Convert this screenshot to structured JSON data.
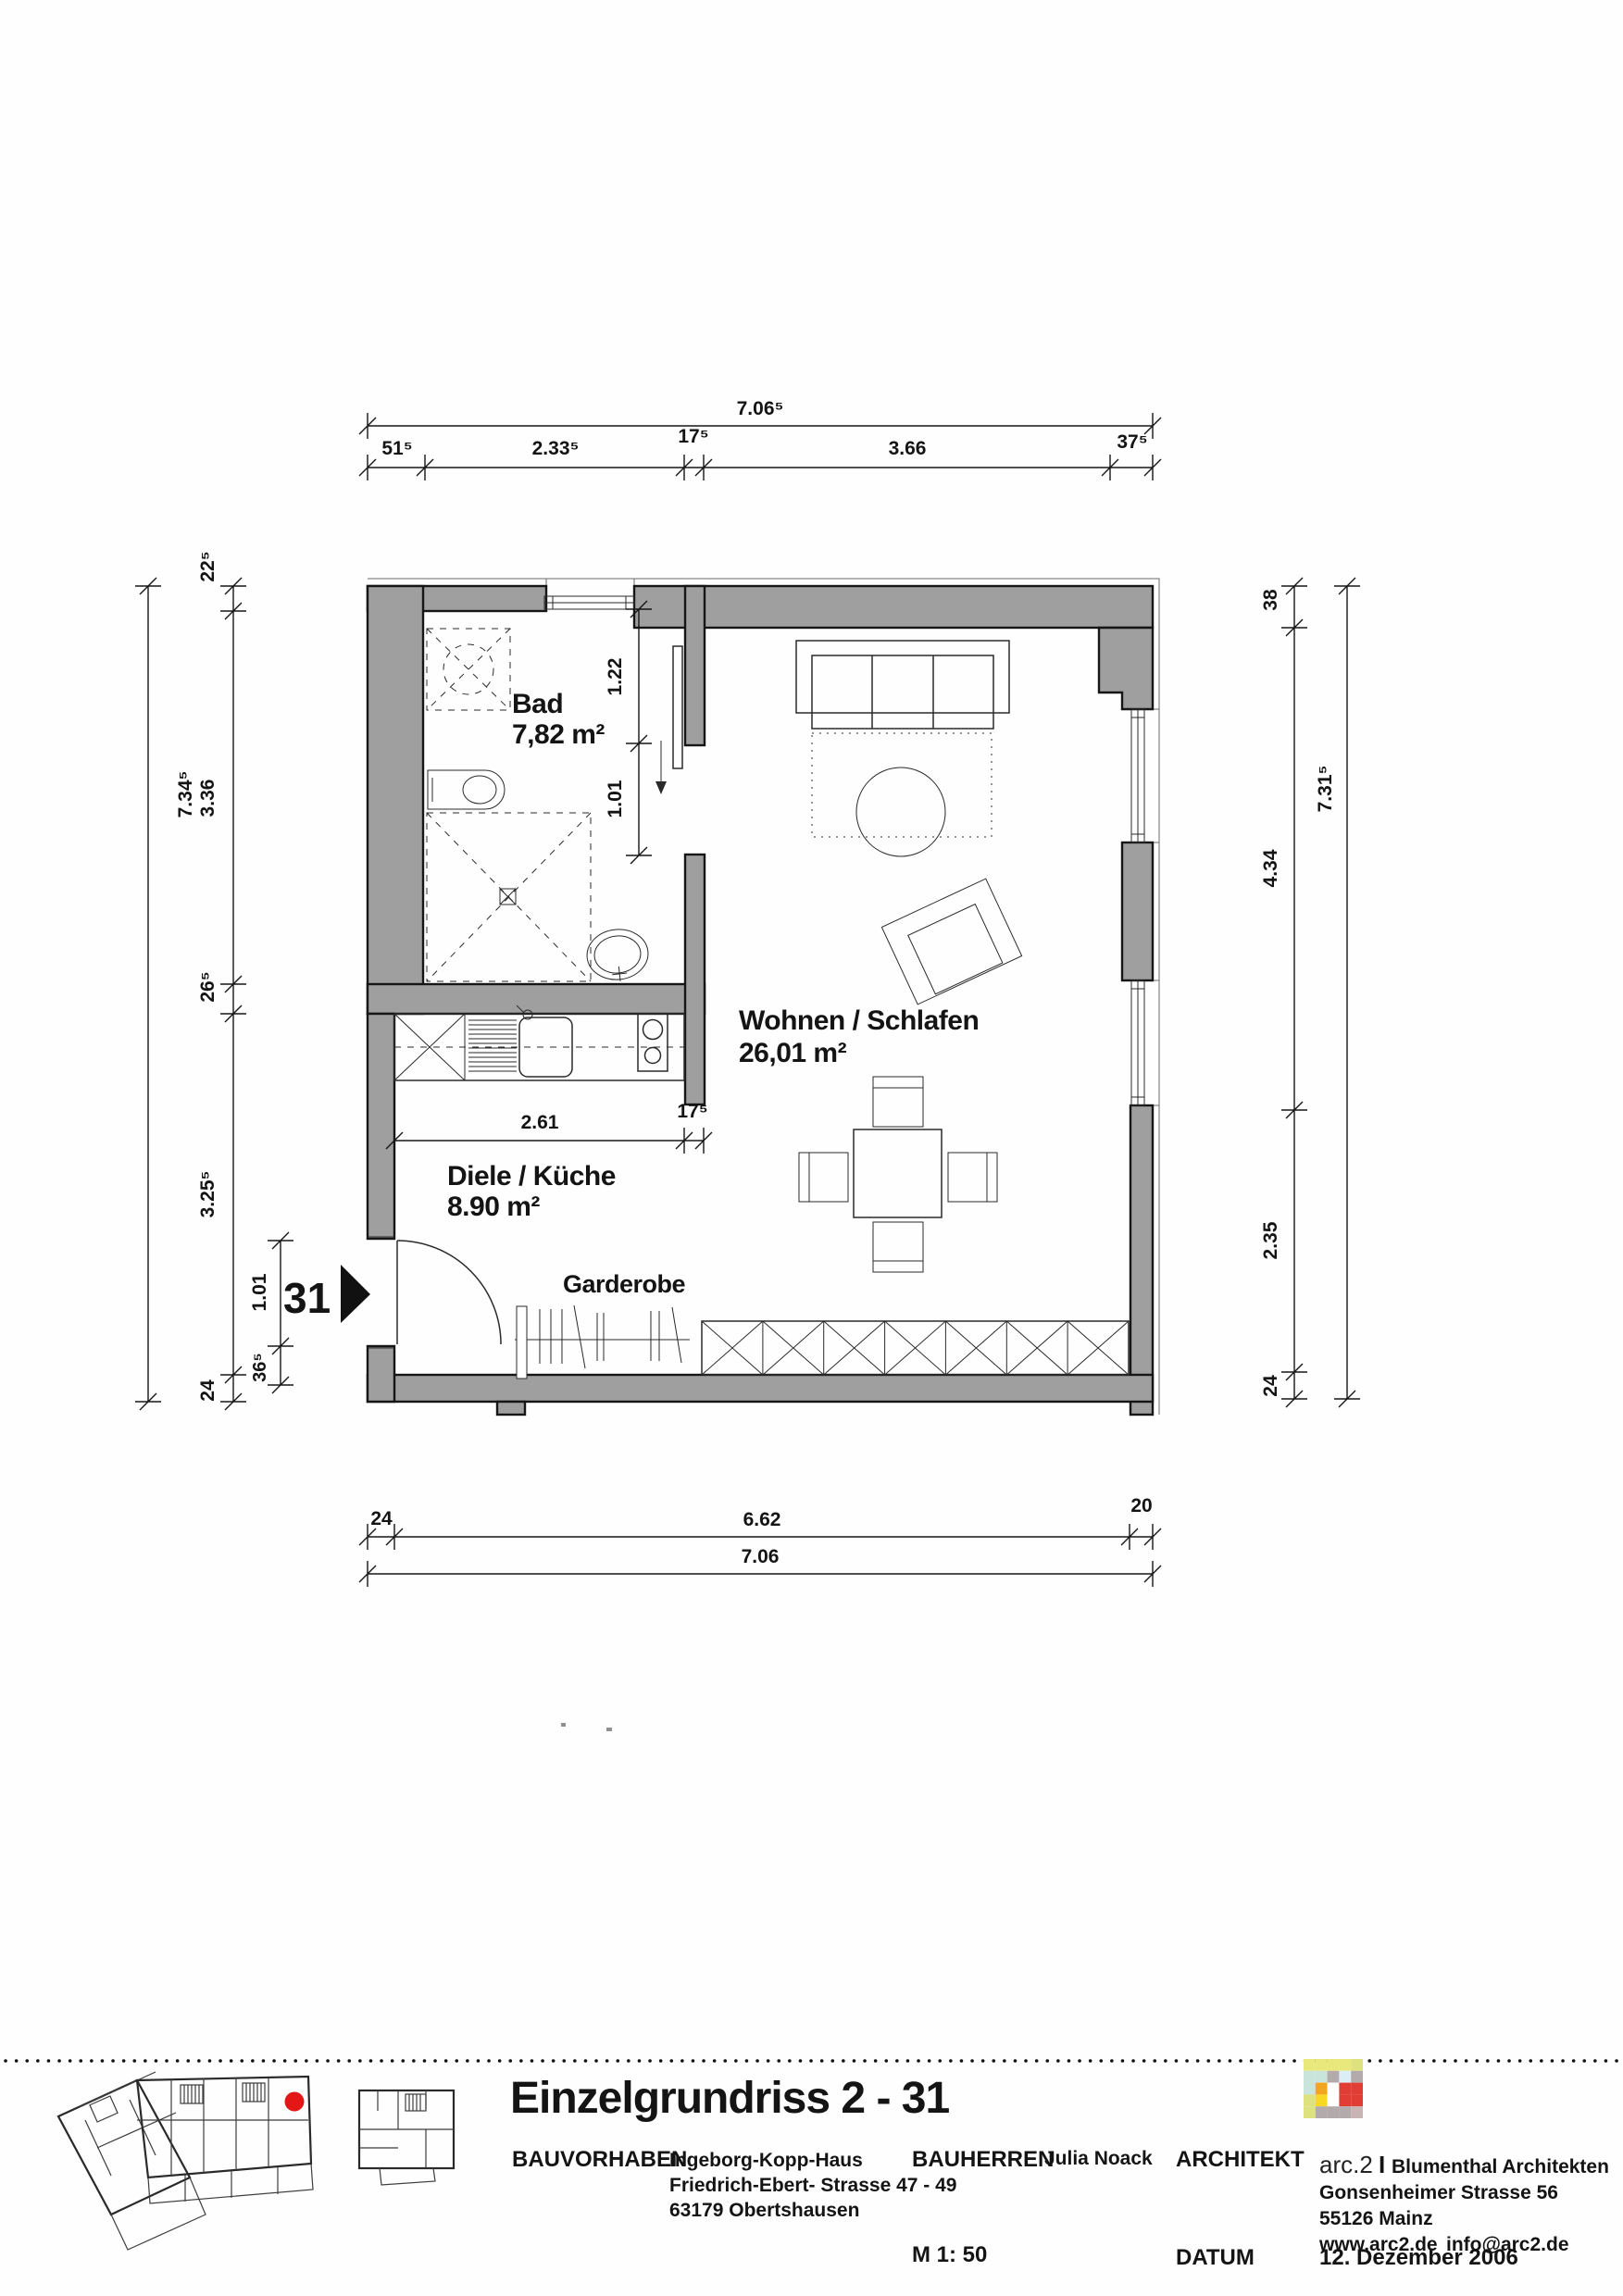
{
  "colors": {
    "wall": "#9f9f9f",
    "line": "#161616",
    "marker_red": "#e41616",
    "logo": {
      "a": "#e8e87c",
      "b": "#dde27e",
      "c": "#c9e4da",
      "d": "#dceef5",
      "e": "#f2a51f",
      "f": "#f8d823",
      "g": "#b3abab",
      "h": "#c9b4b4",
      "r": "#e23d35",
      "w": "#ffffff"
    }
  },
  "rooms": {
    "bad": {
      "name": "Bad",
      "area": "7,82 m²"
    },
    "wohnen": {
      "name": "Wohnen / Schlafen",
      "area": "26,01 m²"
    },
    "diele": {
      "name": "Diele / Küche",
      "area": "8.90 m²"
    },
    "garderobe": "Garderobe"
  },
  "entrance": {
    "unit_number": "31"
  },
  "dims": {
    "top_total": "7.06⁵",
    "top_segments": [
      "51⁵",
      "2.33⁵",
      "17⁵",
      "3.66",
      "37⁵"
    ],
    "left_total": "7.34⁵",
    "left_segments": [
      "22⁵",
      "3.36",
      "26⁵",
      "3.25⁵",
      "24"
    ],
    "right_total": "7.31⁵",
    "right_segments": [
      "38",
      "4.34",
      "2.35",
      "24"
    ],
    "bottom_total": "7.06",
    "bottom_segments": [
      "24",
      "6.62",
      "20"
    ],
    "bad_door": [
      "1.22",
      "1.01"
    ],
    "kitchen": [
      "2.61",
      "17⁵"
    ],
    "entry_door": [
      "1.01",
      "36⁵"
    ]
  },
  "title_block": {
    "title": "Einzelgrundriss 2 - 31",
    "bauvorhaben_label": "BAUVORHABEN",
    "project_name": "Ingeborg-Kopp-Haus",
    "project_street": "Friedrich-Ebert- Strasse 47 - 49",
    "project_city": "63179 Obertshausen",
    "bauherren_label": "BAUHERREN",
    "client": "Julia Noack",
    "architekt_label": "ARCHITEKT",
    "firm_prefix": "arc.2",
    "firm_separator": "I",
    "firm_name": "Blumenthal Architekten",
    "firm_street": "Gonsenheimer Strasse 56",
    "firm_city": "55126 Mainz",
    "firm_web": "www.arc2.de",
    "firm_email": "info@arc2.de",
    "scale": "M 1: 50",
    "datum_label": "DATUM",
    "date": "12. Dezember 2006"
  }
}
